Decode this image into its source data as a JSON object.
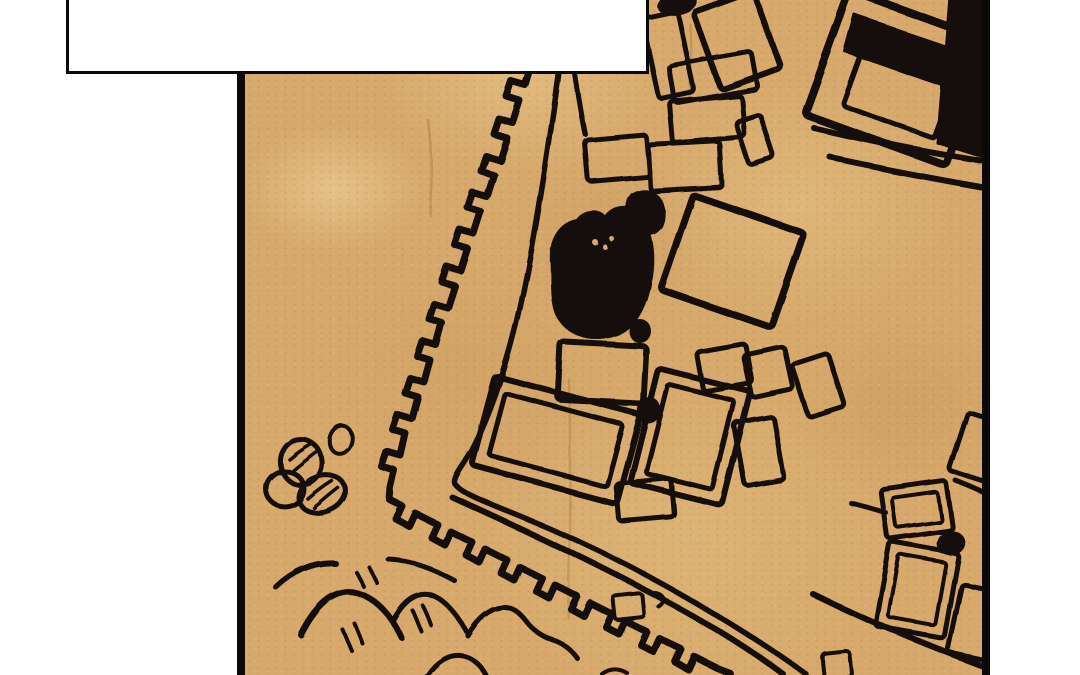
{
  "scene": {
    "kind": "comic panel showing a hand-drawn town map on parchment",
    "bubble_text": ""
  },
  "colors": {
    "page_background": "#ffffff",
    "panel_border": "#0b0a08",
    "ink": "#17110a",
    "parchment_base": "#d7a96c",
    "parchment_light": "#ecd09c",
    "parchment_dark": "#bf8f52",
    "bubble_fill": "#ffffff",
    "bubble_border": "#0a0a0a",
    "crease": "rgba(150,98,45,0.30)"
  },
  "map": {
    "wall": {
      "crenellated_path": "M532,66 L526,86 L512,82 L507,97 L520,101 L513,123 L499,119 L494,134 L507,138 L500,160 L486,156 L481,171 L494,175 L487,197 L473,193 L468,208 L481,212 L474,234 L460,230 L455,245 L468,249 L461,271 L447,267 L442,282 L455,286 L448,308 L434,304 L429,319 L442,323 L436,345 L422,341 L417,356 L430,360 L424,382 L410,378 L405,393 L418,397 L412,419 L398,415 L393,430 L406,434 L401,456 L387,452 L382,467 L395,471 L391,488 L390,500 L402,506 L396,519 L409,526 L415,513 L437,524 L431,537 L444,544 L450,531 L472,542 L466,555 L479,562 L485,549 L507,560 L501,573 L514,580 L520,567 L542,578 L536,591 L549,598 L555,585 L577,596 L571,609 L584,616 L590,603 L612,614 L606,627 L619,634 L625,621 L647,632 L641,645 L654,652 L660,639 L682,650 L676,663 L689,670 L695,657 L717,668 L730,673",
      "inner_path": "M559,72 C547,160 532,260 515,330 C504,374 488,420 472,450 C462,468 452,478 455,484 C460,492 480,500 520,516 C570,536 620,560 670,588 C720,616 770,648 806,674"
    },
    "roads": [
      {
        "d": "M452,497 C520,528 585,558 645,590 C700,618 748,648 784,675",
        "w": 6
      },
      {
        "d": "M813,594 C866,620 928,646 985,667",
        "w": 6
      },
      {
        "d": "M814,128 C868,141 925,152 981,161",
        "w": 6
      },
      {
        "d": "M831,158 C878,168 930,178 981,187",
        "w": 6
      },
      {
        "d": "M572,56 C576,84 580,110 585,134",
        "w": 5
      }
    ],
    "buildings": [
      {
        "cx": 668,
        "cy": 55,
        "w": 36,
        "h": 82,
        "rot": -12,
        "sw": 5
      },
      {
        "cx": 737,
        "cy": 40,
        "w": 64,
        "h": 82,
        "rot": -20,
        "sw": 6
      },
      {
        "cx": 713,
        "cy": 77,
        "w": 84,
        "h": 38,
        "rot": -10,
        "sw": 5
      },
      {
        "cx": 707,
        "cy": 119,
        "w": 72,
        "h": 42,
        "rot": -5,
        "sw": 5
      },
      {
        "cx": 755,
        "cy": 140,
        "w": 26,
        "h": 46,
        "rot": -18,
        "sw": 5
      },
      {
        "cx": 617,
        "cy": 158,
        "w": 62,
        "h": 42,
        "rot": -5,
        "sw": 5
      },
      {
        "cx": 685,
        "cy": 166,
        "w": 72,
        "h": 46,
        "rot": -3,
        "sw": 5
      },
      {
        "cx": 732,
        "cy": 261,
        "w": 118,
        "h": 100,
        "rot": 19,
        "sw": 7
      },
      {
        "cx": 898,
        "cy": 78,
        "w": 150,
        "h": 132,
        "rot": 20,
        "sw": 8
      },
      {
        "cx": 901,
        "cy": 86,
        "w": 98,
        "h": 76,
        "rot": 20,
        "sw": 5
      },
      {
        "cx": 602,
        "cy": 373,
        "w": 86,
        "h": 58,
        "rot": 3,
        "sw": 6
      },
      {
        "cx": 556,
        "cy": 440,
        "w": 150,
        "h": 92,
        "rot": 15,
        "sw": 6,
        "inner": 14
      },
      {
        "cx": 690,
        "cy": 437,
        "w": 95,
        "h": 118,
        "rot": 14,
        "sw": 6,
        "inner": 13
      },
      {
        "cx": 724,
        "cy": 367,
        "w": 50,
        "h": 40,
        "rot": -10,
        "sw": 5
      },
      {
        "cx": 768,
        "cy": 372,
        "w": 42,
        "h": 44,
        "rot": -12,
        "sw": 5
      },
      {
        "cx": 818,
        "cy": 385,
        "w": 38,
        "h": 56,
        "rot": -18,
        "sw": 5
      },
      {
        "cx": 759,
        "cy": 451,
        "w": 40,
        "h": 64,
        "rot": -10,
        "sw": 5
      },
      {
        "cx": 645,
        "cy": 500,
        "w": 56,
        "h": 38,
        "rot": -5,
        "sw": 5
      },
      {
        "cx": 629,
        "cy": 607,
        "w": 30,
        "h": 24,
        "rot": -6,
        "sw": 4
      },
      {
        "cx": 917,
        "cy": 510,
        "w": 66,
        "h": 50,
        "rot": -8,
        "sw": 5,
        "inner": 10
      },
      {
        "cx": 917,
        "cy": 590,
        "w": 70,
        "h": 86,
        "rot": 10,
        "sw": 5,
        "inner": 11
      },
      {
        "cx": 980,
        "cy": 448,
        "w": 46,
        "h": 62,
        "rot": 18,
        "sw": 5
      },
      {
        "cx": 974,
        "cy": 622,
        "w": 40,
        "h": 70,
        "rot": 12,
        "sw": 5
      },
      {
        "cx": 837,
        "cy": 665,
        "w": 28,
        "h": 26,
        "rot": -6,
        "sw": 4
      }
    ],
    "ink_blots": [
      {
        "d": "M551,262 C549,238 561,223 577,220 C583,211 599,208 606,218 C613,206 631,204 641,216 C652,231 656,257 650,284 C645,311 633,330 613,336 C590,343 566,335 556,314 C550,299 552,278 551,262 Z"
      },
      {
        "d": "M632,194 C643,187 655,190 661,201 C666,214 664,228 653,233 C642,238 631,230 628,216 C626,207 627,199 632,194 Z"
      },
      {
        "d": "M855,15 L973,55 L961,92 L845,52 Z"
      },
      {
        "d": "M949,-4 L985,-4 L985,158 L937,143 Z"
      }
    ],
    "ink_dots": [
      {
        "cx": 677,
        "cy": 4,
        "rx": 20,
        "ry": 11,
        "rot": -10
      },
      {
        "cx": 640,
        "cy": 331,
        "rx": 11,
        "ry": 12,
        "rot": 0
      },
      {
        "cx": 649,
        "cy": 410,
        "rx": 11,
        "ry": 13,
        "rot": 10
      },
      {
        "cx": 951,
        "cy": 543,
        "rx": 14,
        "ry": 12,
        "rot": -15
      }
    ],
    "blot_specks": [
      {
        "cx": 595,
        "cy": 242,
        "r": 3
      },
      {
        "cx": 605,
        "cy": 247,
        "r": 2.5
      },
      {
        "cx": 612,
        "cy": 239,
        "r": 2.5
      }
    ],
    "rocks": [
      {
        "cx": 301,
        "cy": 462,
        "rx": 21,
        "ry": 23,
        "rot": -10,
        "sw": 5
      },
      {
        "cx": 341,
        "cy": 440,
        "rx": 11,
        "ry": 14,
        "rot": 15,
        "sw": 4
      },
      {
        "cx": 285,
        "cy": 489,
        "rx": 19,
        "ry": 18,
        "rot": 0,
        "sw": 5
      },
      {
        "cx": 322,
        "cy": 494,
        "rx": 24,
        "ry": 18,
        "rot": -20,
        "sw": 5
      }
    ],
    "rock_hatches": [
      {
        "d": "M289,459 C296,453 303,448 310,444"
      },
      {
        "d": "M293,470 C301,463 309,457 317,451"
      },
      {
        "d": "M308,499 C316,492 324,486 332,481"
      },
      {
        "d": "M314,508 C322,501 330,494 338,488"
      }
    ],
    "waves": [
      {
        "d": "M276,587 C294,570 314,562 335,563",
        "w": 6
      },
      {
        "d": "M389,560 C412,561 433,569 455,581",
        "w": 5
      },
      {
        "d": "M301,635 C315,607 331,593 348,592 C362,592 377,601 389,616 C394,623 398,630 401,637",
        "w": 6
      },
      {
        "d": "M393,622 C404,601 417,593 429,595 C443,598 456,612 466,631",
        "w": 5
      },
      {
        "d": "M467,635 C477,618 489,608 501,607 C512,606 520,613 527,622 C533,630 542,637 552,640 C562,643 571,649 577,658",
        "w": 5
      },
      {
        "d": "M427,675 C436,661 448,654 460,655 C471,656 480,664 486,675",
        "w": 5
      },
      {
        "d": "M602,674 C610,668 619,668 627,673",
        "w": 4
      }
    ],
    "wave_ticks": [
      {
        "d": "M356,572 C359,577 362,582 364,587"
      },
      {
        "d": "M369,567 C372,573 376,579 378,584"
      },
      {
        "d": "M342,629 C345,636 348,643 351,650"
      },
      {
        "d": "M354,623 C357,630 360,637 362,643"
      },
      {
        "d": "M413,611 C416,618 419,625 421,631"
      },
      {
        "d": "M423,606 C426,612 429,619 431,625"
      }
    ],
    "marks": [
      {
        "d": "M655,593 C664,594 667,602 659,607",
        "w": 4
      },
      {
        "d": "M851,503 C863,506 875,509 886,513",
        "w": 5
      },
      {
        "d": "M956,481 C966,485 976,489 984,493",
        "w": 5
      }
    ],
    "creases": [
      {
        "d": "M428,120 C431,150 432,180 430,215"
      },
      {
        "d": "M569,380 C571,440 570,520 568,618"
      },
      {
        "d": "M690,25 C692,50 691,75 689,100"
      }
    ]
  }
}
